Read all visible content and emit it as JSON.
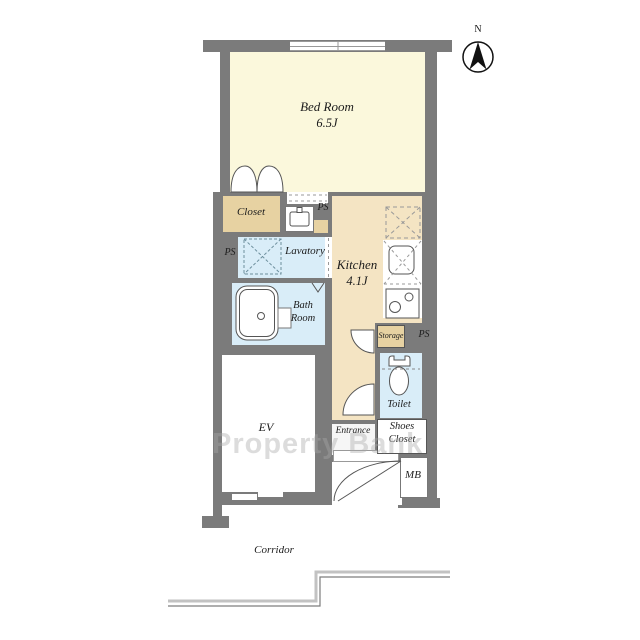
{
  "compass": {
    "label": "N"
  },
  "watermark": {
    "text": "Property Bank"
  },
  "rooms": {
    "bedroom": {
      "name": "Bed Room",
      "size": "6.5J"
    },
    "closet": {
      "name": "Closet"
    },
    "lavatory": {
      "name": "Lavatory"
    },
    "bathroom": {
      "line1": "Bath",
      "line2": "Room"
    },
    "kitchen": {
      "name": "Kitchen",
      "size": "4.1J"
    },
    "storage": {
      "name": "Storage"
    },
    "toilet": {
      "name": "Toilet"
    },
    "elevator": {
      "name": "EV"
    },
    "entrance": {
      "name": "Entrance"
    },
    "shoes_closet": {
      "line1": "Shoes",
      "line2": "Closet"
    },
    "meter_box": {
      "name": "MB"
    },
    "corridor": {
      "name": "Corridor"
    }
  },
  "labels": {
    "pipe_space": "PS"
  },
  "colors": {
    "wall": "#7b7b7b",
    "bedroom_cream": "#fbf8dc",
    "closet_tan": "#e7d2a2",
    "kitchen_tan": "#f4e4c3",
    "water_blue": "#d9edf8",
    "white": "#ffffff",
    "corridor_line_light": "#c2c2c2",
    "corridor_line_dark": "#7d7d7d"
  }
}
